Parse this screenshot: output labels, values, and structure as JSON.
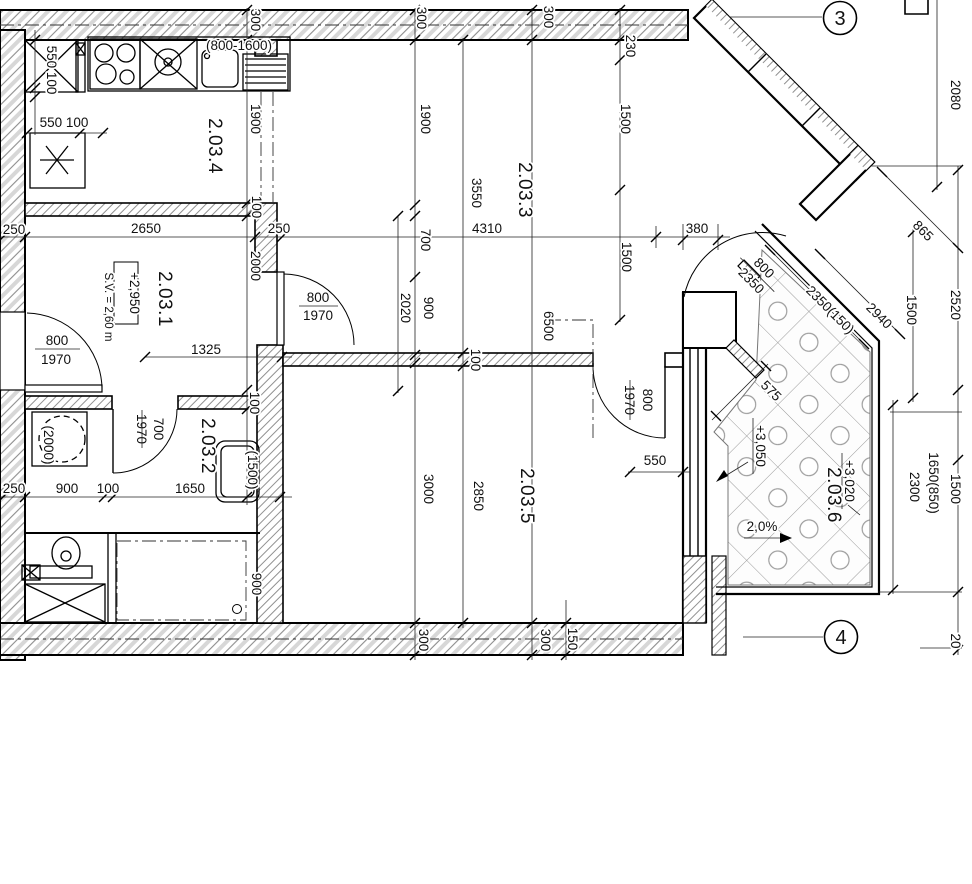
{
  "rooms": {
    "r1": "2.03.1",
    "r1_sv": "S.V. = 2,60 m",
    "r1_level": "+2,950",
    "r2": "2.03.2",
    "r3": "2.03.3",
    "r4": "2.03.4",
    "r5": "2.03.5",
    "r6": "2.03.6",
    "r6_level_a": "+3,050",
    "r6_level_b": "+3,020",
    "r6_slope": "2,0%"
  },
  "markers": {
    "m3": "3",
    "m4": "4"
  },
  "doors": {
    "entry_w": "800",
    "entry_h": "1970",
    "hall_w": "800",
    "hall_h": "1970",
    "bath_w": "700",
    "bath_h": "1970",
    "living_w": "800",
    "living_h": "1970",
    "balcony_w": "800",
    "balcony_h": "2350"
  },
  "fixtures": {
    "tub": "(1500)",
    "washer": "(2000)",
    "window_range": "(800-1600)"
  },
  "labels": {
    "w300_top1": "300",
    "w300_top2": "300",
    "w300_top3": "300",
    "w300_bot1": "300",
    "w300_bot2": "300",
    "w150_bot": "150",
    "o230": "230",
    "k550100_v": "550 100",
    "k550100_h": "550 100",
    "v1900_l": "1900",
    "v1900_m": "1900",
    "v1500_top": "1500",
    "v1500_mid": "1500",
    "v1500_right": "1500",
    "v1500_win": "1500",
    "v2080": "2080",
    "v3550": "3550",
    "v2000": "2000",
    "v2020": "2020",
    "v900_m": "900",
    "v700_m": "700",
    "v3000": "3000",
    "v2850": "2850",
    "v6500": "6500",
    "h2650": "2650",
    "h250_l": "250",
    "h250_r": "250",
    "h4310": "4310",
    "h380": "380",
    "h1325": "1325",
    "h550": "550",
    "h250_b": "250",
    "h900_b": "900",
    "h100_b": "100",
    "h1650_b": "1650",
    "v900_b": "900",
    "d100_a": "100",
    "d100_b": "100",
    "d100_c": "100",
    "d865": "865",
    "d2940": "2940",
    "d2350_150": "2350(150)",
    "d575": "575",
    "v2520": "2520",
    "v1650_850": "1650(850)",
    "v2300": "2300",
    "v20": "20"
  }
}
